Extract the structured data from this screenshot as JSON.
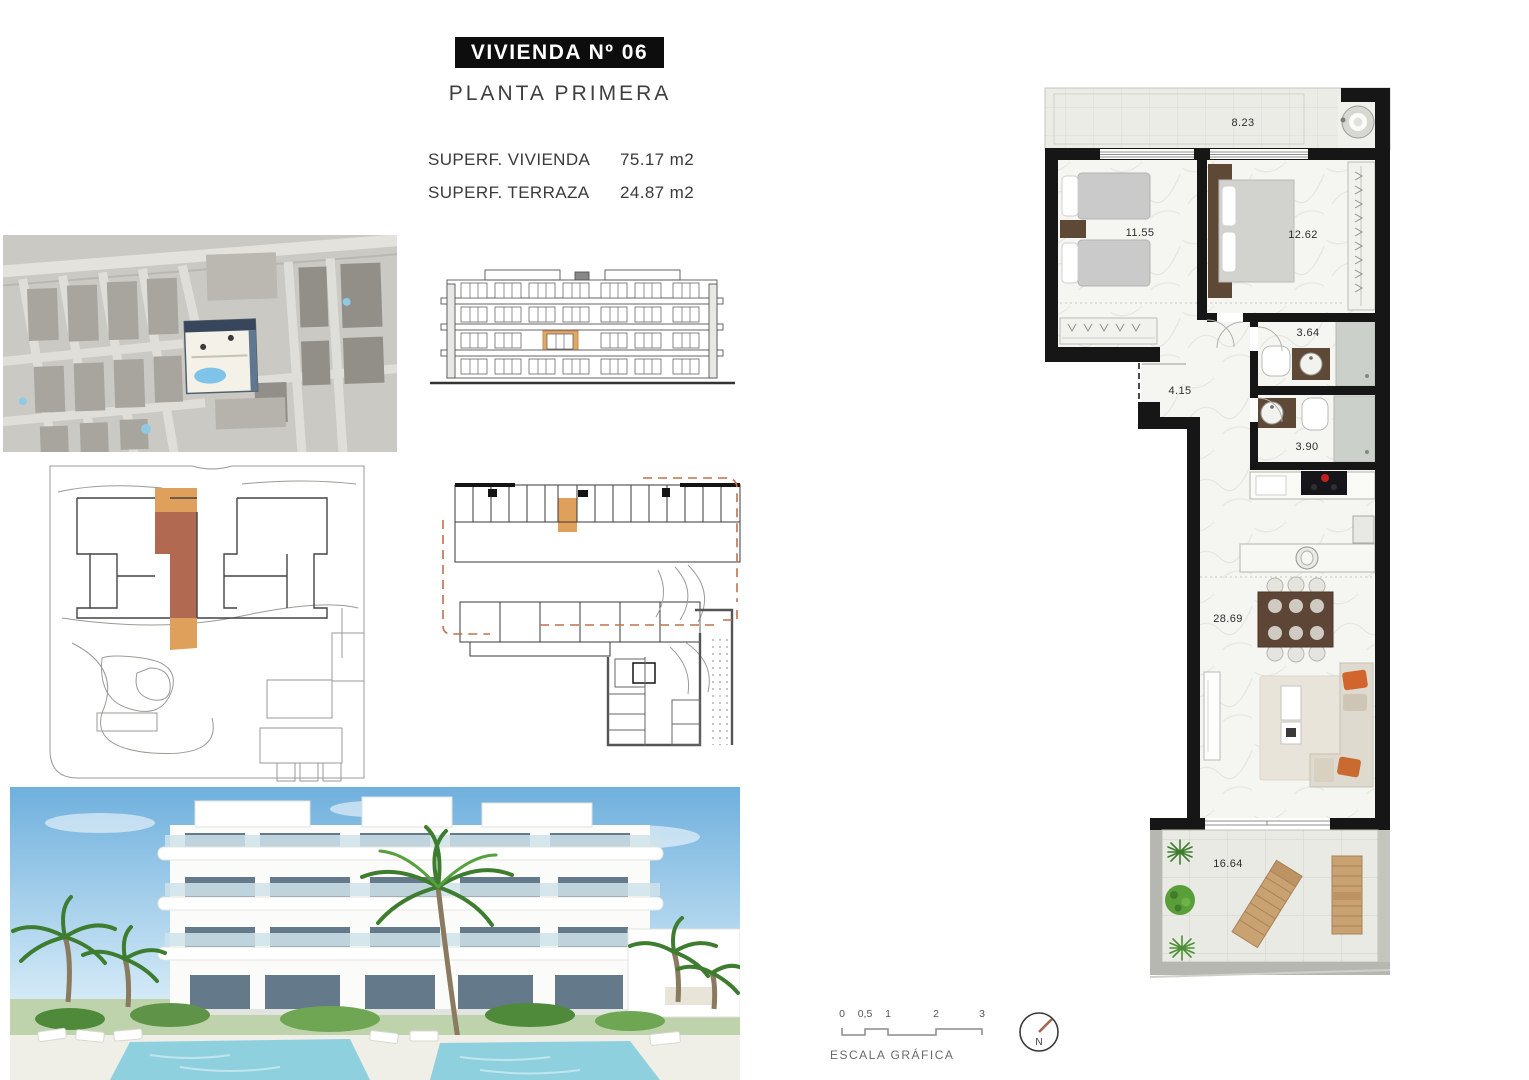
{
  "title": {
    "unit": "VIVIENDA Nº 06",
    "floor": "PLANTA PRIMERA"
  },
  "areas": [
    {
      "label": "SUPERF. VIVIENDA",
      "value": "75.17 m2"
    },
    {
      "label": "SUPERF. TERRAZA",
      "value": "24.87 m2"
    }
  ],
  "floorplan": {
    "rooms": {
      "terrace_top": "8.23",
      "bedroom_1": "11.55",
      "bedroom_2": "12.62",
      "bathroom_1": "3.64",
      "hallway": "4.15",
      "bathroom_2": "3.90",
      "living_dining": "28.69",
      "terrace_bottom": "16.64"
    }
  },
  "scalebar": {
    "ticks": [
      "0",
      "0,5",
      "1",
      "2",
      "3"
    ],
    "caption": "ESCALA GRÁFICA"
  },
  "compass": {
    "north": "N"
  },
  "colors": {
    "highlight_orange": "#DFA05C",
    "highlight_terracotta": "#B26951",
    "wall_black": "#161616",
    "cooktop_red": "#C41E1E",
    "pool_blue": "#8FD0DE",
    "plant_green": "#4E8F35",
    "lounger_tan": "#C9A271",
    "compass_needle": "#A0674F"
  }
}
